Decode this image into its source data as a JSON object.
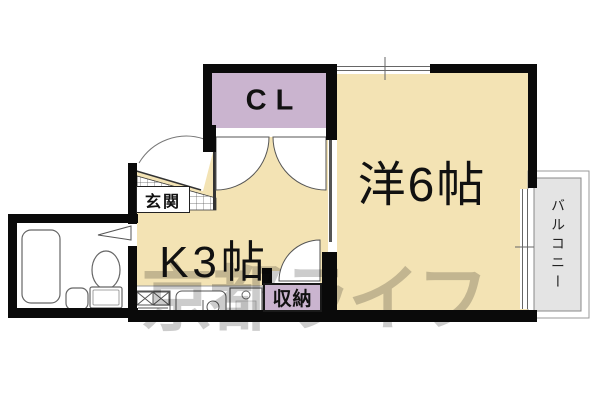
{
  "floorplan": {
    "rooms": {
      "closet": {
        "label": "CL"
      },
      "western_room": {
        "label": "洋6帖"
      },
      "kitchen": {
        "label": "K3帖"
      },
      "entrance": {
        "label": "玄関"
      },
      "storage": {
        "label": "収納"
      },
      "balcony": {
        "label": "バルコニー"
      }
    },
    "watermark": {
      "text": "京都ライフ"
    },
    "colors": {
      "room_fill": "#f3e3b4",
      "closet_fill": "#cab4cf",
      "storage_fill": "#cab4cf",
      "balcony_fill": "#e4e4e4",
      "wall": "#0a0a0a",
      "watermark": "rgba(0,0,0,0.20)"
    },
    "fixture_icons": [
      "bathtub-icon",
      "toilet-icon",
      "wash-basin-icon",
      "gas-stove-icon",
      "kitchen-sink-icon",
      "appliance-space-icon",
      "door-swing-icon",
      "double-door-swing-icon",
      "window-icon",
      "tile-floor-icon"
    ]
  }
}
